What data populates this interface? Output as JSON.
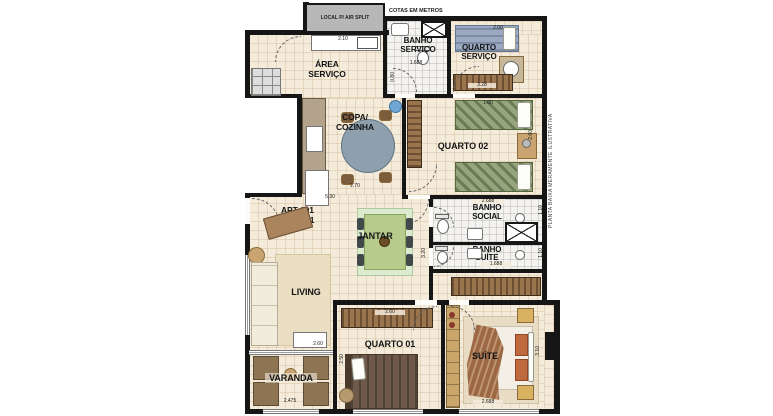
{
  "colors": {
    "wall": "#161616",
    "floor": "#f4ebda",
    "bath_floor": "#f4f3ef",
    "wood": "#9a744c",
    "green_bed": "#97a57d",
    "blue_bed": "#9aa8c0",
    "jantar_table": "#b6cb8c",
    "suite_pillow": "#bf6a3e",
    "gray_box": "#b7b7b7"
  },
  "notes": {
    "local_air": "LOCAL P/ AIR SPLIT",
    "cotas": "COTAS EM METROS",
    "apt": "APT 101\nAO 2301",
    "side_note": "PLANTA BAIXA  MERAMENTE ILUSTRATIVA"
  },
  "rooms": {
    "area_servico": {
      "label": "ÁREA\nSERVIÇO",
      "dim_top": "2.10"
    },
    "banho_servico": {
      "label": "BANHO\nSERVIÇO",
      "dim_width": "1.688",
      "dim_door": "0.80"
    },
    "quarto_servico": {
      "label": "QUARTO\nSERVIÇO",
      "dim_bed": "2.00",
      "dim_wardrobe": "3.28"
    },
    "copa_cozinha": {
      "label": "COPA/\nCOZINHA",
      "dim_a": "2.70",
      "dim_b": "5.30"
    },
    "quarto02": {
      "label": "QUARTO 02",
      "dim_bed": "1.00",
      "dim_side": "2.60",
      "dim_bottom": "2.688"
    },
    "banho_social": {
      "label": "BANHO\nSOCIAL",
      "dim_shaft_top": "1.10",
      "dim_shaft_bottom": "1.10"
    },
    "banho_suite": {
      "label": "BANHO\nSUÍTE",
      "dim_width": "1.688",
      "dim_side": "3.20"
    },
    "jantar": {
      "label": "JANTAR"
    },
    "living": {
      "label": "LIVING",
      "dim_bottom": "2.60"
    },
    "varanda": {
      "label": "VARANDA",
      "dim_bottom": "2.475"
    },
    "quarto01": {
      "label": "QUARTO 01",
      "dim_wardrobe": "2.60",
      "dim_side": "2.50"
    },
    "suite": {
      "label": "SUÍTE",
      "dim_bottom": "2.688",
      "dim_side": "3.10"
    }
  }
}
